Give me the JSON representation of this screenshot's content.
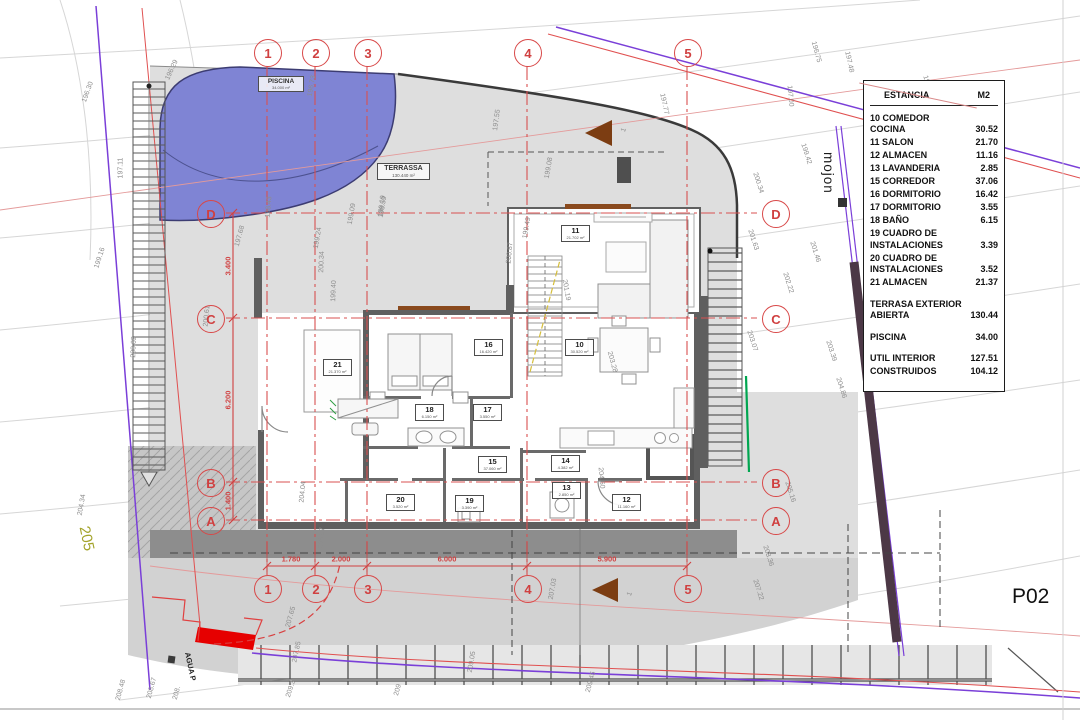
{
  "sheet": {
    "code": "P02"
  },
  "legend": {
    "header": {
      "label": "ESTANCIA",
      "unit": "M2"
    },
    "rows": [
      {
        "label": "10 COMEDOR COCINA",
        "value": "30.52"
      },
      {
        "label": "11 SALON",
        "value": "21.70"
      },
      {
        "label": "12 ALMACEN",
        "value": "11.16"
      },
      {
        "label": "13 LAVANDERIA",
        "value": "2.85"
      },
      {
        "label": "15 CORREDOR",
        "value": "37.06"
      },
      {
        "label": "16 DORMITORIO",
        "value": "16.42"
      },
      {
        "label": "17 DORMITORIO",
        "value": "3.55"
      },
      {
        "label": "18 BAÑO",
        "value": "6.15"
      },
      {
        "label": "19 CUADRO DE INSTALACIONES",
        "value": "3.39"
      },
      {
        "label": "20 CUADRO DE INSTALACIONES",
        "value": "3.52"
      },
      {
        "label": "21 ALMACEN",
        "value": "21.37"
      },
      {
        "label": "TERRASA EXTERIOR ABIERTA",
        "value": "130.44",
        "gap": true
      },
      {
        "label": "PISCINA",
        "value": "34.00",
        "gap": true
      },
      {
        "label": "UTIL INTERIOR",
        "value": "127.51",
        "gap": true
      },
      {
        "label": "CONSTRUIDOS",
        "value": "104.12"
      }
    ]
  },
  "grid": {
    "columns": [
      "1",
      "2",
      "3",
      "4",
      "5"
    ],
    "rows": [
      "D",
      "C",
      "B",
      "A"
    ],
    "column_dims": [
      "1.780",
      "2.000",
      "6.000",
      "5.900"
    ],
    "row_dims": [
      "3.400",
      "6.200",
      "1.400"
    ]
  },
  "areas": {
    "piscina": {
      "label": "PISCINA",
      "area": "34.000 m²"
    },
    "terrassa": {
      "label": "TERRASSA",
      "area": "130.440 m²"
    }
  },
  "rooms": [
    {
      "id": "21",
      "area": "21.370 m²",
      "x": 336,
      "y": 367
    },
    {
      "id": "16",
      "area": "16.420 m²",
      "x": 487,
      "y": 347
    },
    {
      "id": "18",
      "area": "6.150 m²",
      "x": 428,
      "y": 412
    },
    {
      "id": "17",
      "area": "3.550 m²",
      "x": 486,
      "y": 412
    },
    {
      "id": "11",
      "area": "21.702 m²",
      "x": 574,
      "y": 233
    },
    {
      "id": "10",
      "area": "30.520 m²",
      "x": 578,
      "y": 347
    },
    {
      "id": "15",
      "area": "37.060 m²",
      "x": 491,
      "y": 464
    },
    {
      "id": "14",
      "area": "4.382 m²",
      "x": 564,
      "y": 463
    },
    {
      "id": "13",
      "area": "2.850 m²",
      "x": 565,
      "y": 490
    },
    {
      "id": "20",
      "area": "3.520 m²",
      "x": 399,
      "y": 502
    },
    {
      "id": "19",
      "area": "3.390 m²",
      "x": 468,
      "y": 503
    },
    {
      "id": "12",
      "area": "11.160 m²",
      "x": 625,
      "y": 502
    }
  ],
  "labels": {
    "mojon": "mojon",
    "parcel_number": "205",
    "agua": "AGUA P"
  },
  "contour_labels": [
    {
      "t": "196.30",
      "x": 88,
      "y": 92,
      "r": -70
    },
    {
      "t": "196.29",
      "x": 172,
      "y": 70,
      "r": -65
    },
    {
      "t": "197.11",
      "x": 121,
      "y": 168,
      "r": -90
    },
    {
      "t": "199.16",
      "x": 100,
      "y": 258,
      "r": -72
    },
    {
      "t": "200.02",
      "x": 134,
      "y": 347,
      "r": -88
    },
    {
      "t": "204.34",
      "x": 82,
      "y": 505,
      "r": -80
    },
    {
      "t": "197.68",
      "x": 240,
      "y": 236,
      "r": -75
    },
    {
      "t": "198.43",
      "x": 269,
      "y": 207,
      "r": -85
    },
    {
      "t": "196.73",
      "x": 312,
      "y": 86,
      "r": -80
    },
    {
      "t": "198.59",
      "x": 383,
      "y": 207,
      "r": -80
    },
    {
      "t": "197.55",
      "x": 497,
      "y": 120,
      "r": -82
    },
    {
      "t": "199.08",
      "x": 549,
      "y": 168,
      "r": -80
    },
    {
      "t": "199.49",
      "x": 527,
      "y": 228,
      "r": -80
    },
    {
      "t": "199.24",
      "x": 318,
      "y": 238,
      "r": -80
    },
    {
      "t": "199.09",
      "x": 352,
      "y": 214,
      "r": -80
    },
    {
      "t": "199.19",
      "x": 382,
      "y": 206,
      "r": -82
    },
    {
      "t": "199.40",
      "x": 334,
      "y": 291,
      "r": -88
    },
    {
      "t": "200.34",
      "x": 322,
      "y": 262,
      "r": -88
    },
    {
      "t": "200.61",
      "x": 207,
      "y": 316,
      "r": -85
    },
    {
      "t": "200.87",
      "x": 510,
      "y": 253,
      "r": -85
    },
    {
      "t": "201.19",
      "x": 566,
      "y": 290,
      "r": 80
    },
    {
      "t": "203.28",
      "x": 612,
      "y": 362,
      "r": 75
    },
    {
      "t": "204.60",
      "x": 601,
      "y": 478,
      "r": 85
    },
    {
      "t": "204.04",
      "x": 303,
      "y": 492,
      "r": -85
    },
    {
      "t": "196.75",
      "x": 816,
      "y": 52,
      "r": 75
    },
    {
      "t": "197.00",
      "x": 790,
      "y": 96,
      "r": 85
    },
    {
      "t": "197.48",
      "x": 849,
      "y": 62,
      "r": 78
    },
    {
      "t": "198.27",
      "x": 928,
      "y": 86,
      "r": 72
    },
    {
      "t": "197.77",
      "x": 664,
      "y": 104,
      "r": 78
    },
    {
      "t": "199.42",
      "x": 806,
      "y": 154,
      "r": 72
    },
    {
      "t": "200.34",
      "x": 758,
      "y": 183,
      "r": 72
    },
    {
      "t": "201.63",
      "x": 753,
      "y": 240,
      "r": 72
    },
    {
      "t": "201.46",
      "x": 815,
      "y": 252,
      "r": 72
    },
    {
      "t": "202.22",
      "x": 788,
      "y": 283,
      "r": 72
    },
    {
      "t": "203.07",
      "x": 752,
      "y": 341,
      "r": 72
    },
    {
      "t": "203.39",
      "x": 831,
      "y": 351,
      "r": 72
    },
    {
      "t": "204.86",
      "x": 841,
      "y": 388,
      "r": 72
    },
    {
      "t": "205.16",
      "x": 790,
      "y": 492,
      "r": 72
    },
    {
      "t": "208.36",
      "x": 768,
      "y": 556,
      "r": 72
    },
    {
      "t": "207.22",
      "x": 758,
      "y": 590,
      "r": 72
    },
    {
      "t": "205.97",
      "x": 322,
      "y": 538,
      "r": -85
    },
    {
      "t": "207.03",
      "x": 553,
      "y": 589,
      "r": -80
    },
    {
      "t": "207.65",
      "x": 291,
      "y": 617,
      "r": -75
    },
    {
      "t": "207.85",
      "x": 297,
      "y": 652,
      "r": -78
    },
    {
      "t": "208.48",
      "x": 121,
      "y": 690,
      "r": -75
    },
    {
      "t": "208.67",
      "x": 152,
      "y": 688,
      "r": -75
    },
    {
      "t": "208.",
      "x": 177,
      "y": 693,
      "r": -75
    },
    {
      "t": "209.3",
      "x": 291,
      "y": 689,
      "r": -72
    },
    {
      "t": "209",
      "x": 398,
      "y": 690,
      "r": -75
    },
    {
      "t": "209.05",
      "x": 472,
      "y": 662,
      "r": -80
    },
    {
      "t": "209.45",
      "x": 591,
      "y": 682,
      "r": -75
    },
    {
      "t": "1",
      "x": 624,
      "y": 130,
      "r": -70
    },
    {
      "t": "1",
      "x": 630,
      "y": 594,
      "r": -70
    }
  ]
}
